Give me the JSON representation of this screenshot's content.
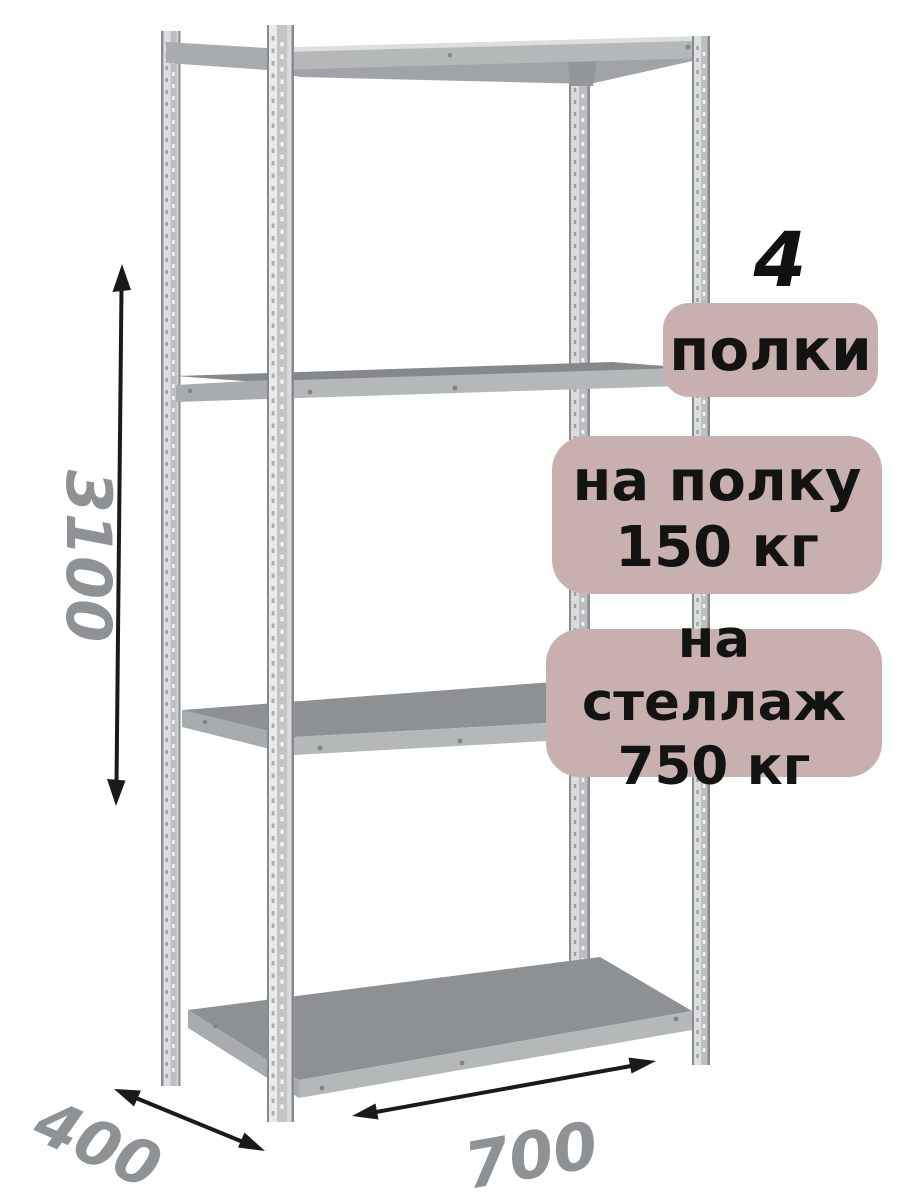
{
  "product": {
    "shelf_count": {
      "number": "4",
      "label": "полки"
    },
    "per_shelf_load": {
      "line1": "на полку",
      "line2": "150 кг"
    },
    "total_load": {
      "line1": "на стеллаж",
      "line2": "750 кг"
    }
  },
  "dimensions": {
    "height_mm": "3100",
    "width_mm": "700",
    "depth_mm": "400"
  },
  "colors": {
    "background": "#ffffff",
    "badge_bg": "#c9b0b0",
    "badge_text": "#131313",
    "dimension_label": "#8f9294",
    "arrow": "#1a1a1a",
    "post_light": "#dcdee0",
    "post_mid": "#bcbfc1",
    "post_edge": "#868a8c",
    "shelf_top": "#8e9193",
    "shelf_front": "#b5b8b9",
    "shelf_side": "#a8acae",
    "shelf_underside": "#a0a4a6"
  }
}
